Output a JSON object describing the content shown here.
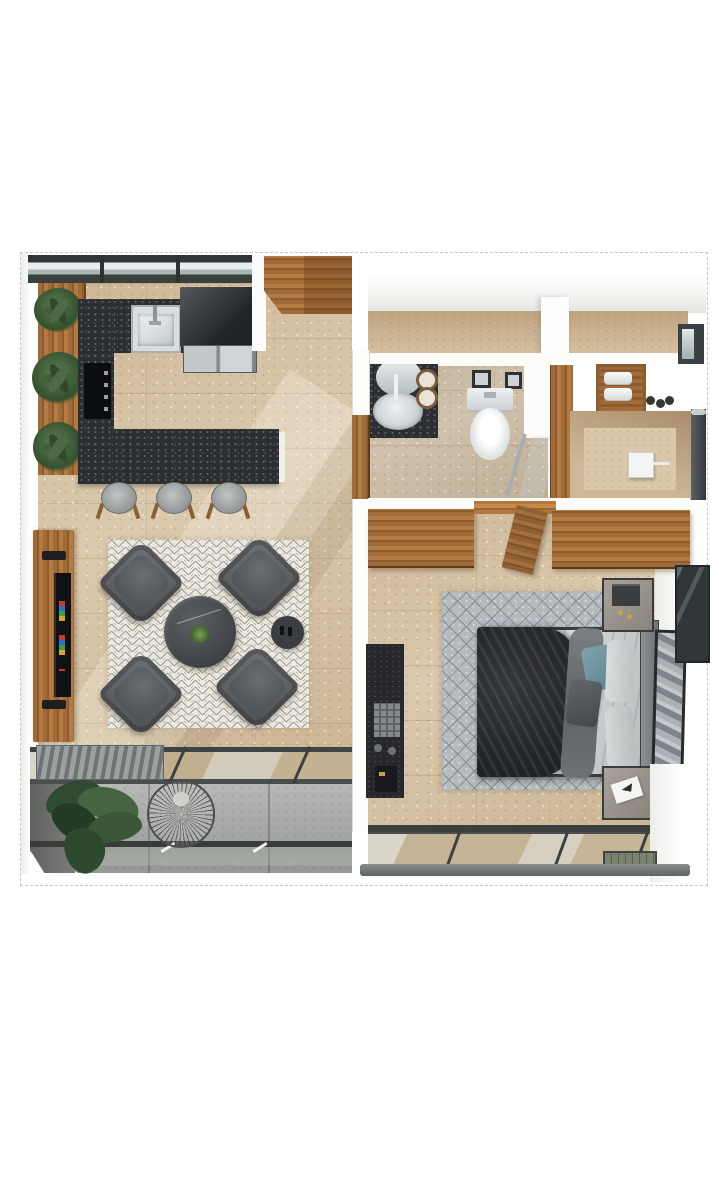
{
  "scene": {
    "type": "3d-floorplan-top-view",
    "rooms": [
      {
        "name": "kitchen",
        "floor": "travertine"
      },
      {
        "name": "living-room",
        "floor": "travertine"
      },
      {
        "name": "bathroom",
        "floor": "travertine"
      },
      {
        "name": "shower-room",
        "floor": "travertine"
      },
      {
        "name": "bedroom",
        "floor": "travertine"
      },
      {
        "name": "living-balcony",
        "floor": "concrete"
      },
      {
        "name": "bedroom-balcony",
        "floor": "travertine"
      }
    ],
    "furniture": {
      "kitchen": [
        "window-strip",
        "plant-shelf",
        "potted-plants-x3",
        "granite-counter",
        "steel-sink",
        "cooktop",
        "dark-appliance",
        "steel-oven",
        "island-bar",
        "bar-stools-x3",
        "entry-wood-door"
      ],
      "living_room": [
        "chevron-rug",
        "armchairs-x4",
        "round-marble-coffee-table",
        "round-side-table",
        "tv-wood-panel",
        "tv-screen"
      ],
      "living_balcony": [
        "louvered-bench",
        "sliding-glass-door",
        "large-plant",
        "wire-lounge-chair",
        "glass-railing"
      ],
      "bathroom": [
        "granite-vanity",
        "oval-sink",
        "round-mirror",
        "towel-rolls-x2",
        "wall-pictures-x2",
        "toilet",
        "glass-shower-screen",
        "towel-niche",
        "green-bottles-x3",
        "shower-head"
      ],
      "bedroom": [
        "wood-wardrobe",
        "open-wardrobe-door",
        "diamond-rug",
        "double-bed",
        "dark-duvet",
        "gray-throw",
        "teal-pillow",
        "gray-pillow",
        "white-pillows-x2",
        "headboard",
        "nightstands-x2",
        "table-lamp",
        "dark-dresser",
        "leaning-artwork",
        "glass-cabinet"
      ],
      "bedroom_balcony": [
        "sliding-glass-door",
        "railing",
        "planter-box"
      ]
    }
  },
  "palette": {
    "travertine": "#d6c3a6",
    "granite": "#2c2f32",
    "wood": "#a06b38",
    "concrete": "#a6a8a5",
    "rug-cream": "#ebe8e0",
    "rug-gray": "#b5babf",
    "chair": "#4c4f52",
    "wall-white": "#fdfdfc",
    "frame-dark": "#3c4043",
    "bed-duvet": "#2a2d2f",
    "pillow-teal": "#6f94a2",
    "plant-green": "#3f5f3a",
    "railing-gray": "#5e6263",
    "steel": "#c3c8ca"
  }
}
